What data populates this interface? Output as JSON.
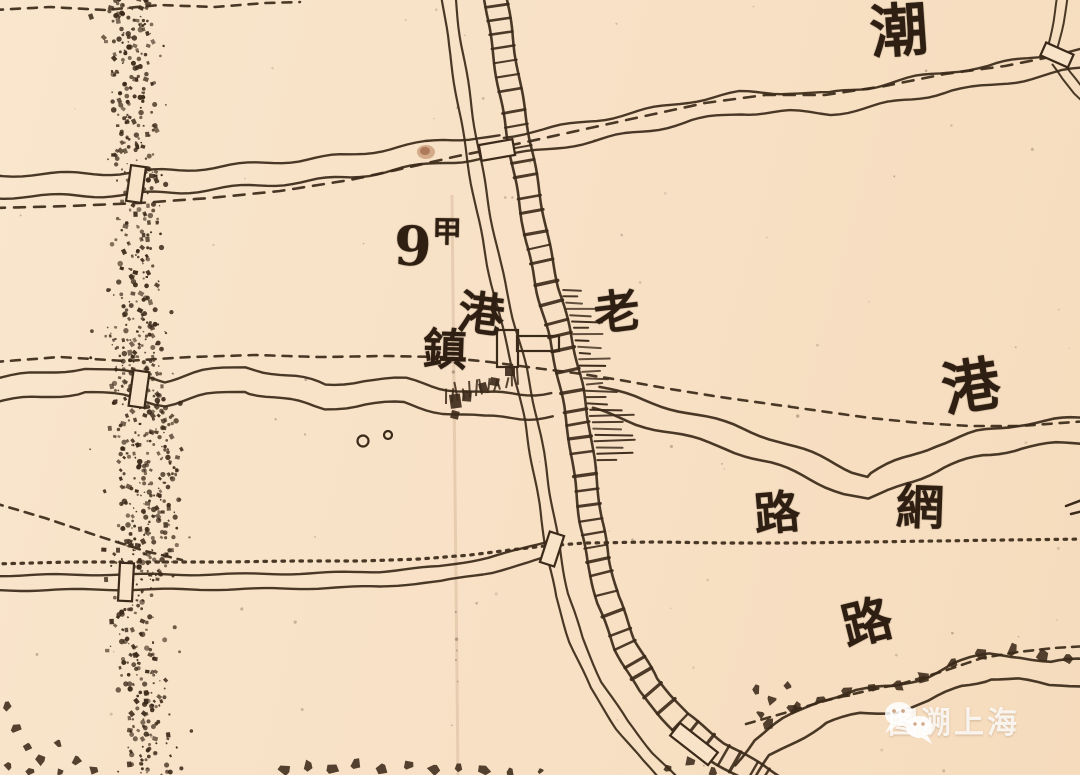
{
  "map_type": "historical-cadastral-map",
  "colors": {
    "paper": "#f8e3c9",
    "ink": "#3b2919",
    "watermark": "rgba(255,255,255,0.82)"
  },
  "labels": [
    {
      "id": "river-name-top",
      "text": "潮"
    },
    {
      "id": "plot-number",
      "text": "9"
    },
    {
      "id": "plot-number-suffix",
      "text": "甲"
    },
    {
      "id": "town-name-char-gang",
      "text": "港"
    },
    {
      "id": "town-name-char-zhen",
      "text": "鎮"
    },
    {
      "id": "town-name-char-lao",
      "text": "老"
    },
    {
      "id": "river-name-right",
      "text": "港"
    },
    {
      "id": "road-label-lu-mid",
      "text": "路"
    },
    {
      "id": "road-label-wang",
      "text": "網"
    },
    {
      "id": "road-label-lu-bottom",
      "text": "路"
    }
  ],
  "watermark": {
    "text": "图溯上海",
    "logo": "wechat-icon"
  }
}
